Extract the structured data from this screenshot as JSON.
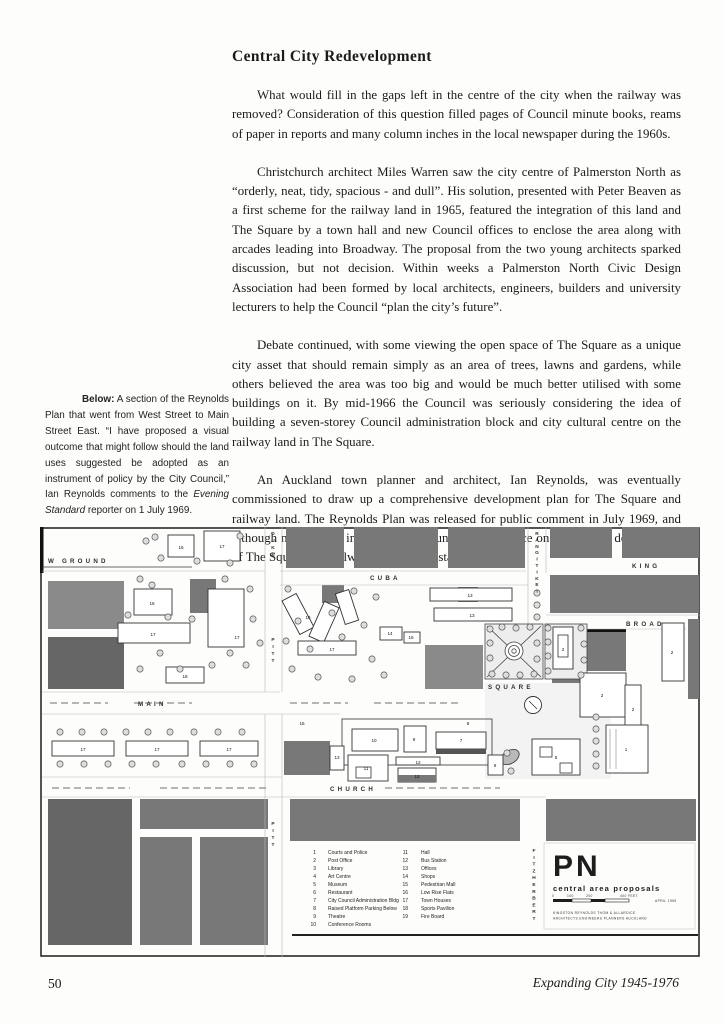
{
  "page": {
    "title": "Central City Redevelopment",
    "paragraphs": [
      "What would fill in the gaps left in the centre of the city when the railway was removed? Consideration of this question filled pages of Council minute books, reams of paper in reports and many column inches in the local newspaper during the 1960s.",
      "Christchurch architect Miles Warren saw the city centre of Palmerston North as “orderly, neat, tidy, spacious - and dull”. His solution, presented with Peter Beaven as a first scheme for the railway land in 1965, featured the integration of this land and The Square by a town hall and new Council offices to enclose the area along with arcades leading into Broadway. The proposal from the two young architects sparked discussion, but not decision. Within weeks a Palmerston North Civic Design Association had been formed by local architects, engineers, builders and university lecturers to help the Council “plan the city’s future”.",
      "Debate continued, with some viewing the open space of The Square as a unique city asset that should remain simply as an area of trees, lawns and gardens, while others believed the area was too big and would be much better utilised with some buildings on it. By mid-1966 the Council was seriously considering the idea of building a seven-storey Council administration block and city cultural centre on the railway land in The Square.",
      "An Auckland town planner and architect, Ian Reynolds, was eventually commissioned to draw up a comprehensive development plan for The Square and railway land. The Reynolds Plan was released for public comment in July 1969, and although not adopted in toto by the Council, its influence on subsequent development of The Square and railway land was substantial."
    ],
    "caption": {
      "label": "Below:",
      "text1": " A section of the Reynolds Plan that went from West Street to Main Street East. “I have proposed a visual outcome that might follow should the land uses suggested be adopted as an instrument of policy by the City Council,” Ian Reynolds comments to the ",
      "italic": "Evening Standard",
      "text2": " reporter on 1 July 1969."
    },
    "footer": {
      "page_number": "50",
      "book_title": "Expanding City 1945-1976"
    }
  },
  "map": {
    "street_labels": {
      "showground": "W GROUND",
      "cuba": "CUBA",
      "king": "KING",
      "broadway": "BROAD",
      "main": "MAIN",
      "church": "CHURCH",
      "square": "SQUARE",
      "duke": "DUKE",
      "pitt_north": "PITT",
      "pitt_south": "PITT",
      "rangitikei": "RANGITIKEI",
      "fitzherbert": "FITZHERBERT"
    },
    "legend": {
      "col1": [
        {
          "n": "1",
          "label": "Courts and Police"
        },
        {
          "n": "2",
          "label": "Post Office"
        },
        {
          "n": "3",
          "label": "Library"
        },
        {
          "n": "4",
          "label": "Art Centre"
        },
        {
          "n": "5",
          "label": "Museum"
        },
        {
          "n": "6",
          "label": "Restaurant"
        },
        {
          "n": "7",
          "label": "City Council Administration Bldg"
        },
        {
          "n": "8",
          "label": "Raised Platform Parking Below"
        },
        {
          "n": "9",
          "label": "Theatre"
        },
        {
          "n": "10",
          "label": "Conference Rooms"
        }
      ],
      "col2": [
        {
          "n": "11",
          "label": "Hall"
        },
        {
          "n": "12",
          "label": "Bus Station"
        },
        {
          "n": "13",
          "label": "Offices"
        },
        {
          "n": "14",
          "label": "Shops"
        },
        {
          "n": "15",
          "label": "Pedestrian Mall"
        },
        {
          "n": "16",
          "label": "Low Rise Flats"
        },
        {
          "n": "17",
          "label": "Town Houses"
        },
        {
          "n": "18",
          "label": "Sports Pavilion"
        },
        {
          "n": "19",
          "label": "Fire Board"
        }
      ]
    },
    "title_box": {
      "initials": "PN",
      "subtitle": "central area proposals",
      "scale_labels": [
        "0",
        "100",
        "200",
        "400 FEET"
      ],
      "date": "APRIL 1969",
      "credit_line1": "KINGSTON  REYNOLDS  THOM  &  ALLARDICE",
      "credit_line2": "ARCHITECTS  ENGINEERS  PLANNERS  AUCKLAND"
    },
    "building_labels": [
      {
        "n": "16",
        "x": 141,
        "y": 22
      },
      {
        "n": "17",
        "x": 182,
        "y": 21
      },
      {
        "n": "16",
        "x": 112,
        "y": 78
      },
      {
        "n": "17",
        "x": 113,
        "y": 109
      },
      {
        "n": "17",
        "x": 197,
        "y": 112
      },
      {
        "n": "16",
        "x": 268,
        "y": 92
      },
      {
        "n": "17",
        "x": 292,
        "y": 124
      },
      {
        "n": "18",
        "x": 145,
        "y": 151
      },
      {
        "n": "13",
        "x": 430,
        "y": 70
      },
      {
        "n": "13",
        "x": 432,
        "y": 90
      },
      {
        "n": "14",
        "x": 350,
        "y": 108
      },
      {
        "n": "15",
        "x": 371,
        "y": 112
      },
      {
        "n": "2",
        "x": 523,
        "y": 124
      },
      {
        "n": "2",
        "x": 562,
        "y": 170
      },
      {
        "n": "2",
        "x": 593,
        "y": 184
      },
      {
        "n": "1",
        "x": 586,
        "y": 224
      },
      {
        "n": "2",
        "x": 632,
        "y": 127
      },
      {
        "n": "8",
        "x": 428,
        "y": 198
      },
      {
        "n": "10",
        "x": 334,
        "y": 215
      },
      {
        "n": "9",
        "x": 374,
        "y": 214
      },
      {
        "n": "7",
        "x": 421,
        "y": 215
      },
      {
        "n": "11",
        "x": 326,
        "y": 243
      },
      {
        "n": "12",
        "x": 378,
        "y": 237
      },
      {
        "n": "13",
        "x": 377,
        "y": 251
      },
      {
        "n": "6",
        "x": 455,
        "y": 240
      },
      {
        "n": "5",
        "x": 516,
        "y": 232
      },
      {
        "n": "13",
        "x": 297,
        "y": 232
      },
      {
        "n": "15",
        "x": 262,
        "y": 198
      },
      {
        "n": "17",
        "x": 43,
        "y": 224
      },
      {
        "n": "17",
        "x": 117,
        "y": 224
      },
      {
        "n": "17",
        "x": 189,
        "y": 224
      }
    ],
    "colors": {
      "block_dark": "#666666",
      "block_mid": "#787878",
      "block_light": "#8a8a8a",
      "paper": "#fdfdfb"
    }
  }
}
